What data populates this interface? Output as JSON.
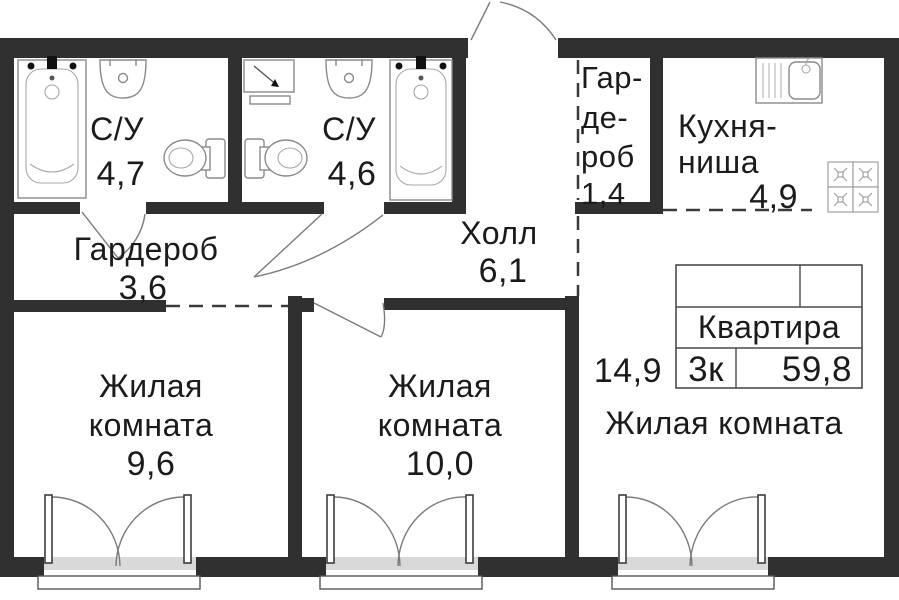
{
  "plan_type": "apartment-floor-plan",
  "colors": {
    "wall": "#303030",
    "text": "#1b1b1b",
    "fixture_line": "#8a8a8a",
    "background": "#ffffff"
  },
  "rooms": {
    "bathroom1": {
      "name": "С/У",
      "area": "4,7"
    },
    "bathroom2": {
      "name": "С/У",
      "area": "4,6"
    },
    "wardrobe_small": {
      "line1": "Гар-",
      "line2": "де-",
      "line3": "роб",
      "area": "1,4"
    },
    "kitchen": {
      "line1": "Кухня-",
      "line2": "ниша",
      "area": "4,9"
    },
    "wardrobe": {
      "name": "Гардероб",
      "area": "3,6"
    },
    "hall": {
      "name": "Холл",
      "area": "6,1"
    },
    "living1": {
      "line1": "Жилая",
      "line2": "комната",
      "area": "9,6"
    },
    "living2": {
      "line1": "Жилая",
      "line2": "комната",
      "area": "10,0"
    },
    "living3": {
      "name": "Жилая комната",
      "area": "14,9"
    }
  },
  "info_table": {
    "title": "Квартира",
    "rooms_count": "3к",
    "total_area": "59,8"
  },
  "icons": [
    "bathtub-icon",
    "sink-icon",
    "toilet-icon",
    "washing-machine-icon",
    "kitchen-sink-icon",
    "stove-icon",
    "entrance-door-icon",
    "balcony-door-icon"
  ]
}
